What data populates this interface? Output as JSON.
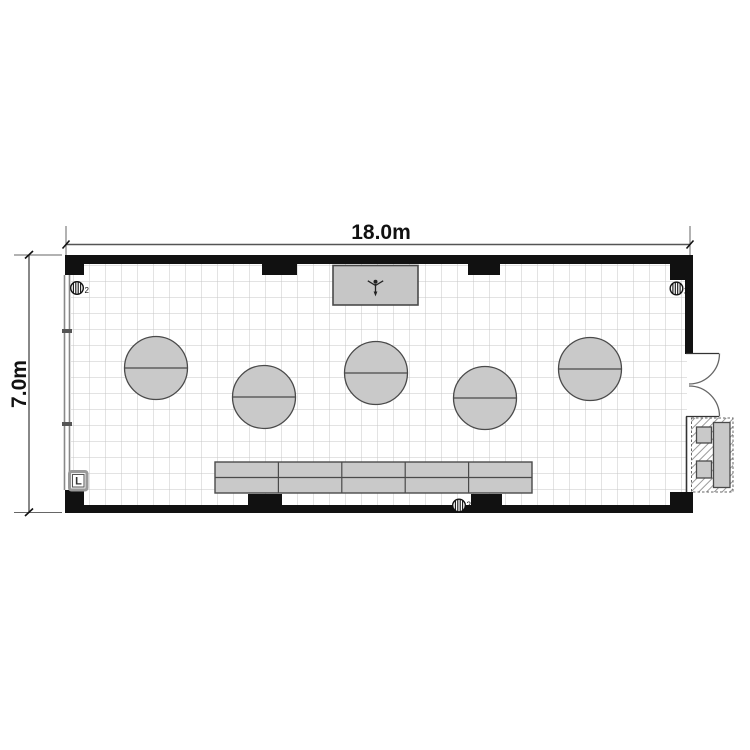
{
  "dimensions": {
    "width_label": "18.0m",
    "height_label": "7.0m",
    "width_m": 18.0,
    "depth_m": 7.0
  },
  "controls": {
    "switch_label": "L"
  },
  "outlets": [
    {
      "id": "outlet-top-left",
      "label": "2"
    },
    {
      "id": "outlet-top-right",
      "label": "2"
    },
    {
      "id": "outlet-bottom-center",
      "label": "2"
    }
  ],
  "furniture": {
    "round_tables": 5,
    "counter_segments": 5,
    "screen_units": 1,
    "service_area_units": 3
  },
  "colors": {
    "wall": "#111111",
    "furniture_fill": "#c9c9c9",
    "furniture_stroke": "#4a4a4a",
    "grid_line": "#c7c7c7",
    "dimension_line": "#666666",
    "dimension_text": "#111111"
  }
}
